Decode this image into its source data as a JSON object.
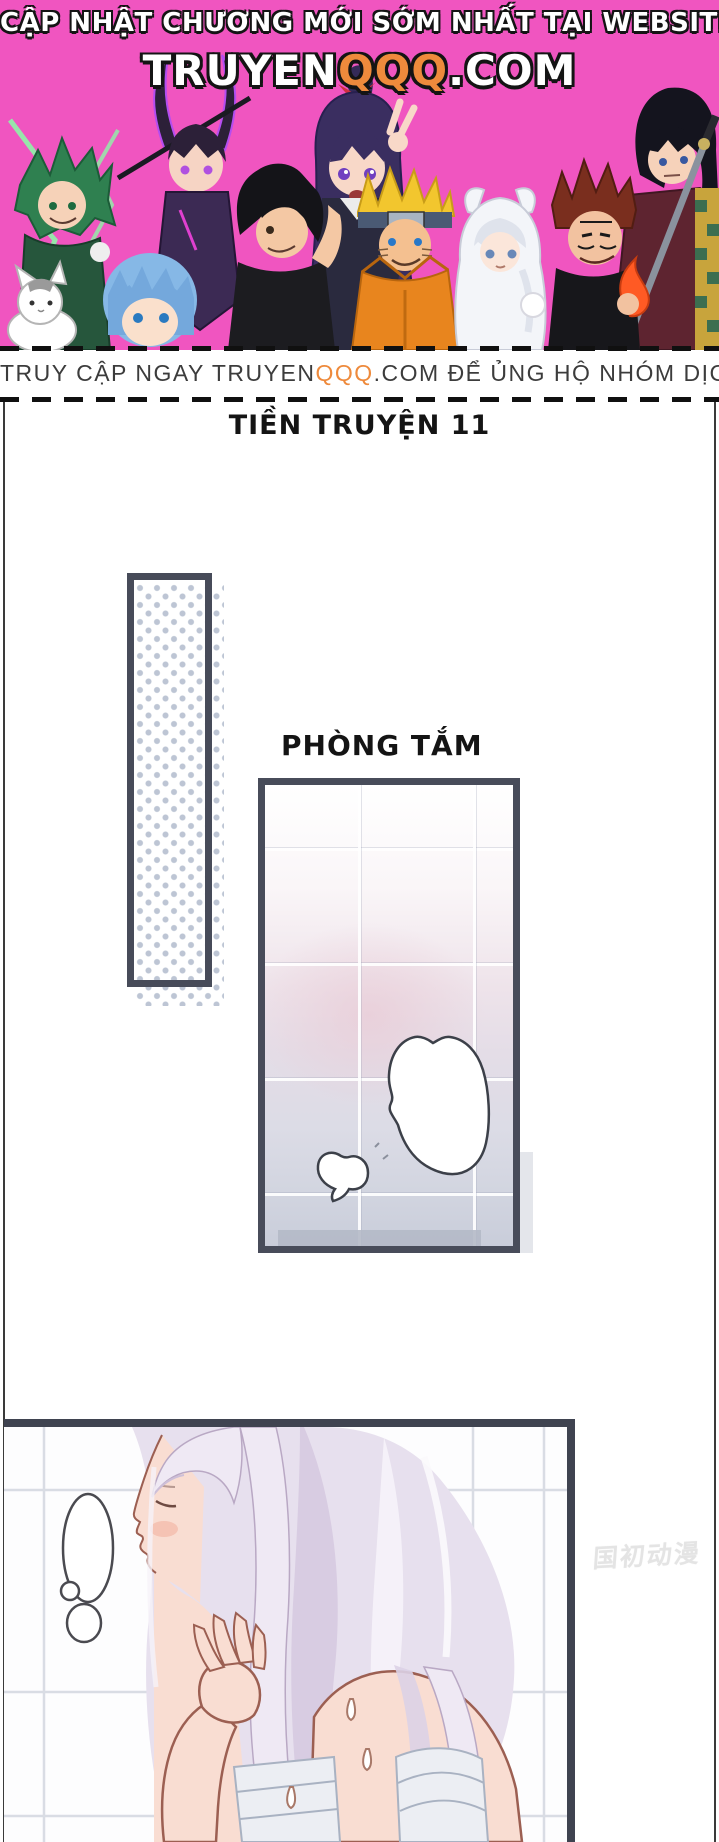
{
  "banner": {
    "bg_color": "#f055c0",
    "accent_color": "#ee8a3c",
    "line1": "CẬP NHẬT CHƯƠNG MỚI SỚM NHẤT TẠI WEBSITE",
    "site": {
      "part1": "TRUYEN",
      "part2": "QQQ",
      "part3": ".COM"
    },
    "characters": [
      "deku-green-hair",
      "katana-girl-purple-twintails",
      "black-messy-hair-boy",
      "ponytail-girl-peace-sign",
      "naruto-blond-headband",
      "cat-ear-hoodie-girl",
      "sukuna-red-spiky-hair",
      "haori-swordsman",
      "white-cat",
      "blue-hair-boy"
    ]
  },
  "promo_strip": {
    "text_before": "TRUY CẬP NGAY TRUYEN",
    "text_mid": "QQQ",
    "text_after": ".COM ĐỂ ỦNG HỘ NHÓM DỊCH"
  },
  "page": {
    "title": "TIỀN TRUYỆN 11",
    "bathroom_label": "PHÒNG TẮM",
    "watermark": "国初动漫",
    "frame_color": "#474b59",
    "dot_color": "#b2bccd"
  }
}
